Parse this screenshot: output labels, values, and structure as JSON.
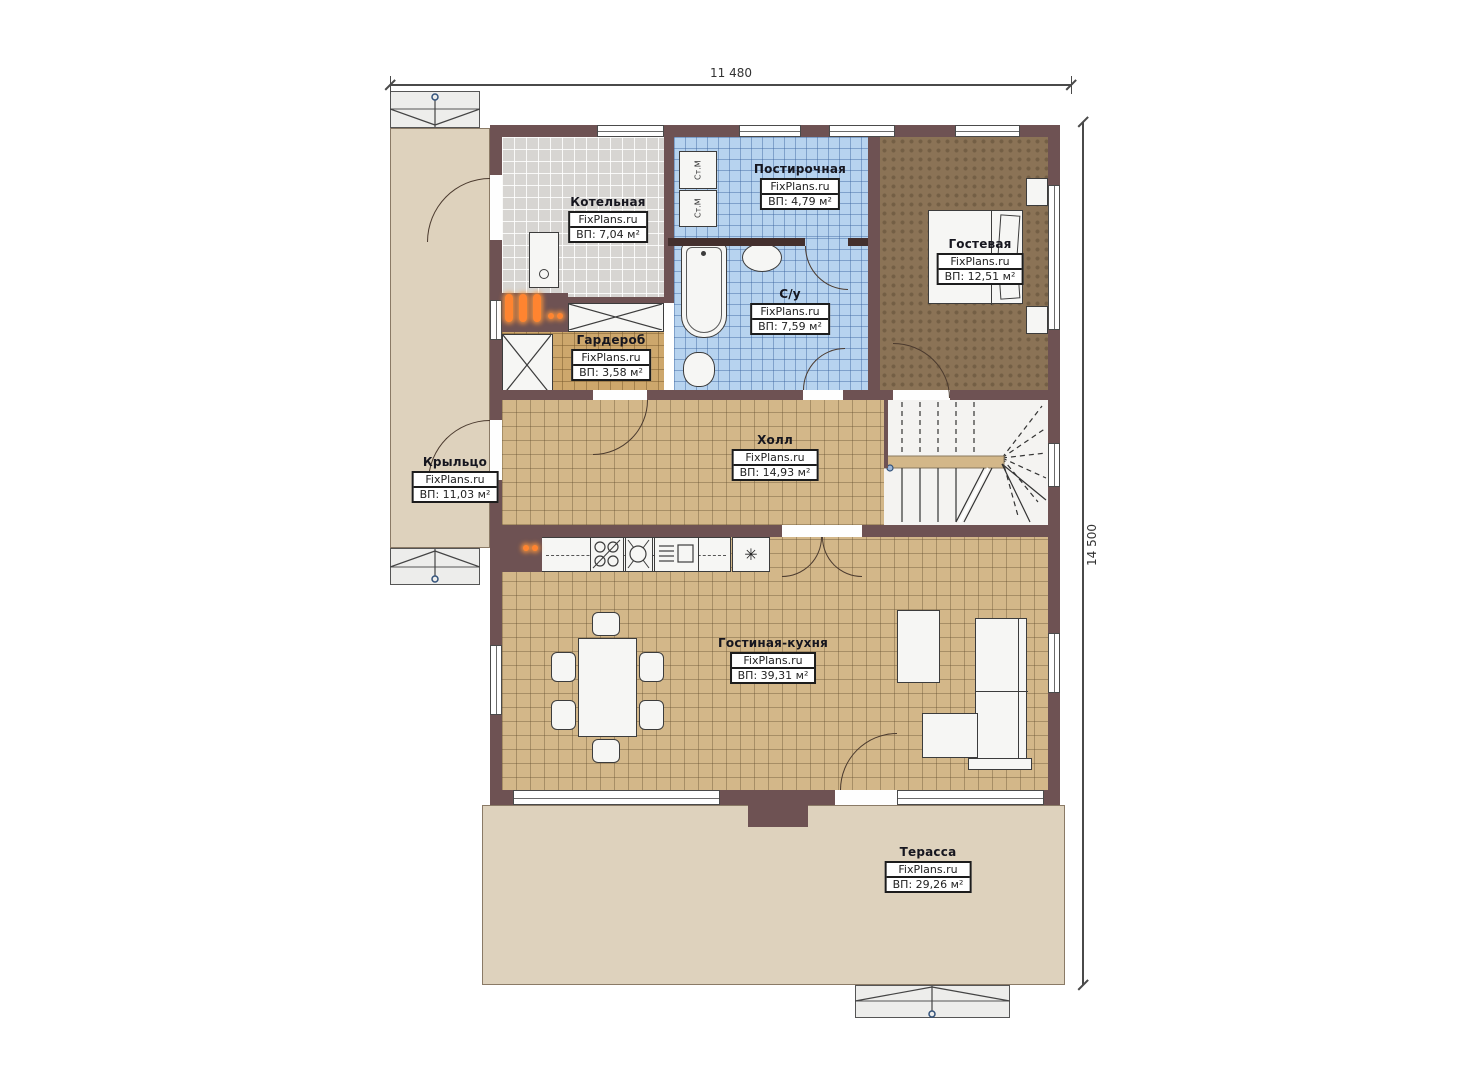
{
  "watermark": "FixPlans.ru",
  "dimensions": {
    "width": "11 480",
    "height": "14 500"
  },
  "rooms": {
    "boiler": {
      "name": "Котельная",
      "area": "ВП: 7,04 м²"
    },
    "laundry": {
      "name": "Постирочная",
      "area": "ВП: 4,79 м²"
    },
    "guest": {
      "name": "Гостевая",
      "area": "ВП: 12,51 м²"
    },
    "wardrobe": {
      "name": "Гардероб",
      "area": "ВП: 3,58 м²"
    },
    "bathroom": {
      "name": "С/у",
      "area": "ВП: 7,59 м²"
    },
    "hall": {
      "name": "Холл",
      "area": "ВП: 14,93 м²"
    },
    "porch": {
      "name": "Крыльцо",
      "area": "ВП: 11,03 м²"
    },
    "living_kitchen": {
      "name": "Гостиная-кухня",
      "area": "ВП: 39,31 м²"
    },
    "terrace": {
      "name": "Терасса",
      "area": "ВП: 29,26 м²"
    }
  },
  "appliances": {
    "washing_machine_label": "Ст.М",
    "fridge_symbol": "✳"
  },
  "colors": {
    "wall": "#6e5253",
    "floor_tan": "#d3b789",
    "floor_gray": "#d7d5d2",
    "floor_blue": "#b7d3ef",
    "floor_brown": "#8b7356",
    "floor_wardrobe": "#cda76c",
    "outdoor": "#ded2bd",
    "radiator": "#ff8430"
  }
}
